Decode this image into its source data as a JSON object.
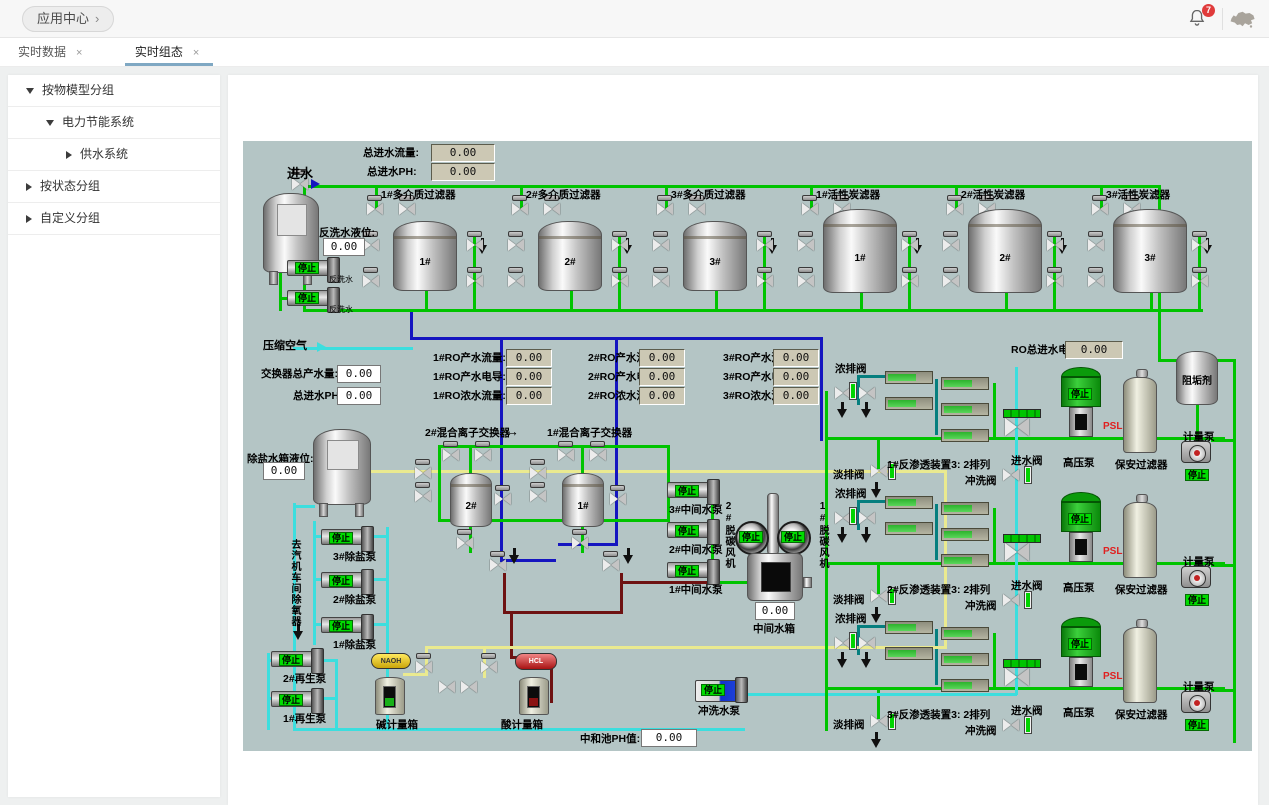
{
  "header": {
    "app_center": "应用中心",
    "chevron": "›",
    "badge": "7"
  },
  "tabs": {
    "items": [
      {
        "label": "实时数据",
        "close": "×"
      },
      {
        "label": "实时组态",
        "close": "×"
      }
    ]
  },
  "sidebar": {
    "items": [
      {
        "label": "按物模型分组"
      },
      {
        "label": "电力节能系统"
      },
      {
        "label": "供水系统"
      },
      {
        "label": "按状态分组"
      },
      {
        "label": "自定义分组"
      }
    ]
  },
  "diagram": {
    "inlet": "进水",
    "compressed_air": "压缩空气",
    "stop": "停止",
    "total_flow_label": "总进水流量:",
    "total_flow_value": "0.00",
    "total_ph_label": "总进水PH:",
    "total_ph_value": "0.00",
    "backwash_level_label": "反洗水液位:",
    "backwash_level_value": "0.00",
    "backwash_pump_label": "反洗水",
    "filters": [
      {
        "title": "1#多介质过滤器",
        "no": "1#"
      },
      {
        "title": "2#多介质过滤器",
        "no": "2#"
      },
      {
        "title": "3#多介质过滤器",
        "no": "3#"
      },
      {
        "title": "1#活性炭滤器",
        "no": "1#"
      },
      {
        "title": "2#活性炭滤器",
        "no": "2#"
      },
      {
        "title": "3#活性炭滤器",
        "no": "3#"
      }
    ],
    "exchanger_total_label": "交换器总产水量:",
    "exchanger_total_value": "0.00",
    "inlet_ph_label": "总进水PH:",
    "inlet_ph_value": "0.00",
    "ro_metrics": [
      {
        "label": "1#RO产水流量:",
        "value": "0.00"
      },
      {
        "label": "2#RO产水流量:",
        "value": "0.00"
      },
      {
        "label": "3#RO产水流量:",
        "value": "0.00"
      },
      {
        "label": "1#RO产水电导:",
        "value": "0.00"
      },
      {
        "label": "2#RO产水电导:",
        "value": "0.00"
      },
      {
        "label": "3#RO产水电导:",
        "value": "0.00"
      },
      {
        "label": "1#RO浓水流量:",
        "value": "0.00"
      },
      {
        "label": "2#RO浓水流量:",
        "value": "0.00"
      },
      {
        "label": "3#RO浓水流量:",
        "value": "0.00"
      }
    ],
    "ro_inlet_cond_label": "RO总进水电导:",
    "ro_inlet_cond_value": "0.00",
    "antiscalant": "阻垢剂",
    "ro_units": [
      {
        "title": "1#反渗透装置3: 2排列",
        "conc_valve": "浓排阀",
        "perm_valve": "淡排阀",
        "inlet_valve": "进水阀",
        "flush_valve": "冲洗阀",
        "hp_pump": "高压泵",
        "psl": "PSL",
        "filter": "保安过滤器",
        "dosing_pump": "计量泵"
      },
      {
        "title": "2#反渗透装置3: 2排列",
        "conc_valve": "浓排阀",
        "perm_valve": "淡排阀",
        "inlet_valve": "进水阀",
        "flush_valve": "冲洗阀",
        "hp_pump": "高压泵",
        "psl": "PSL",
        "filter": "保安过滤器",
        "dosing_pump": "计量泵"
      },
      {
        "title": "3#反渗透装置3: 2排列",
        "conc_valve": "浓排阀",
        "perm_valve": "淡排阀",
        "inlet_valve": "进水阀",
        "flush_valve": "冲洗阀",
        "hp_pump": "高压泵",
        "psl": "PSL",
        "filter": "保安过滤器",
        "dosing_pump": "计量泵"
      }
    ],
    "ion_units": [
      {
        "title": "2#混合离子交换器",
        "no": "2#"
      },
      {
        "title": "1#混合离子交换器",
        "no": "1#"
      }
    ],
    "ion_arrow": "→",
    "desalt_level_label": "除盐水箱液位:",
    "desalt_level_value": "0.00",
    "desalt_pumps": [
      "3#除盐泵",
      "2#除盐泵",
      "1#除盐泵"
    ],
    "to_deaerator": "去汽机车间除氧器",
    "regen_pumps": [
      "2#再生泵",
      "1#再生泵"
    ],
    "naoh": "NAOH",
    "alkali_tank": "碱计量箱",
    "hcl": "HCL",
    "acid_tank": "酸计量箱",
    "mid_pumps": [
      "3#中间水泵",
      "2#中间水泵",
      "1#中间水泵"
    ],
    "mid_tank_label": "中间水箱",
    "mid_tank_value": "0.00",
    "fans": [
      "2#脱碳风机",
      "1#脱碳风机"
    ],
    "flush_pump": "冲洗水泵",
    "neutral_ph_label": "中和池PH值:",
    "neutral_ph_value": "0.00"
  },
  "colors": {
    "accent_tab": "#7fa8c3",
    "pipe_green": "#00c400",
    "pipe_blue": "#1515c0",
    "pipe_cyan": "#3cdede",
    "status_run_green": "#00dc00",
    "alarm_red": "#e02020",
    "canvas": "#b4c5c5"
  }
}
